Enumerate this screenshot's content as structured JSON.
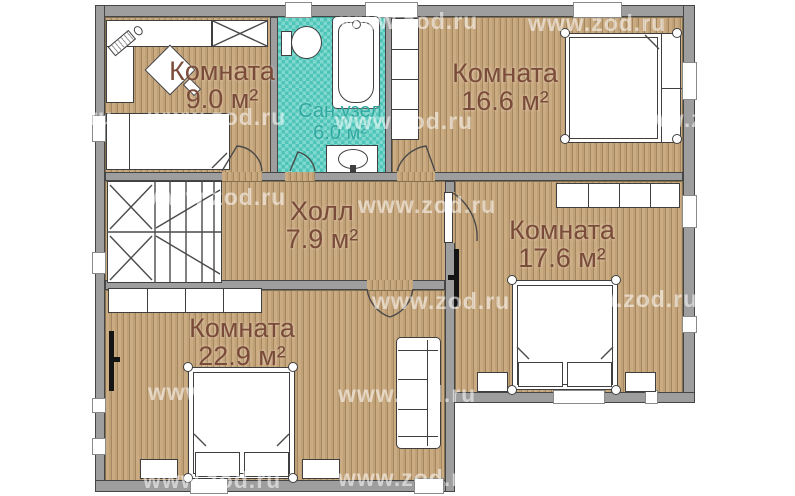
{
  "plan": {
    "watermark_text": "www.zod.ru",
    "rooms": [
      {
        "name": "Комната",
        "area": "9.0 м²"
      },
      {
        "name": "Сан.узел",
        "area": "6.0 м²"
      },
      {
        "name": "Комната",
        "area": "16.6 м²"
      },
      {
        "name": "Холл",
        "area": "7.9 м²"
      },
      {
        "name": "Комната",
        "area": "17.6 м²"
      },
      {
        "name": "Комната",
        "area": "22.9 м²"
      }
    ],
    "colors": {
      "floor_wood": "#c4a47a",
      "floor_tile": "#5fcdc2",
      "wall_gray": "#9e9e9e",
      "label_brown": "#7a4b38",
      "label_teal": "#2fa9a0"
    },
    "furniture_icons": [
      "desk-icon",
      "computer-icon",
      "chair-icon",
      "wardrobe-icon",
      "single-bed-icon",
      "double-bed-icon",
      "nightstand-icon",
      "shelf-icon",
      "sofa-icon",
      "tv-icon",
      "toilet-icon",
      "bathtub-icon",
      "sink-icon",
      "stairs-icon",
      "door-icon",
      "window-icon"
    ]
  }
}
